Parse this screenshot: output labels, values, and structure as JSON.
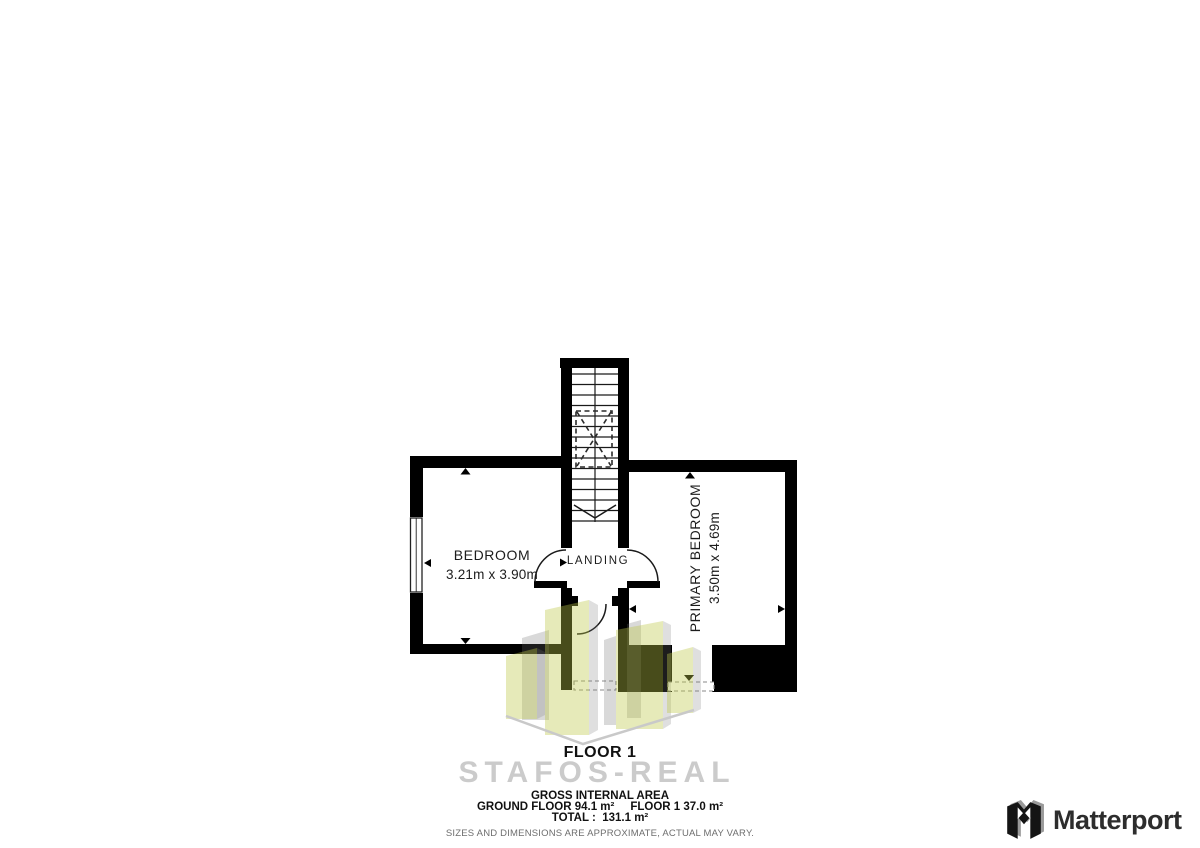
{
  "plan": {
    "floor_label": "FLOOR 1",
    "rooms": {
      "bedroom": {
        "name": "BEDROOM",
        "dims": "3.21m x 3.90m"
      },
      "primary": {
        "name": "PRIMARY BEDROOM",
        "dims": "3.50m x 4.69m"
      },
      "landing": {
        "name": "LANDING"
      }
    }
  },
  "watermark": {
    "brand_text": "STAFOS-REAL",
    "building_fill": "#c5c83c",
    "building_side_fill": "#9a9a9a",
    "diamond_stroke": "#c9c9c9"
  },
  "footer": {
    "area_title": "GROSS INTERNAL AREA",
    "ground_floor": "GROUND FLOOR 94.1 m²",
    "floor1_area": "FLOOR 1 37.0 m²",
    "total": "TOTAL :  131.1 m²",
    "disclaimer": "SIZES AND DIMENSIONS ARE APPROXIMATE, ACTUAL MAY VARY."
  },
  "branding": {
    "name": "Matterport"
  },
  "colors": {
    "wall": "#000000",
    "plan_line": "#1a1a1a",
    "watermark_text": "#cbcbcb",
    "disclaimer_text": "#6e6e6e",
    "logo_text": "#2d2d2d"
  }
}
